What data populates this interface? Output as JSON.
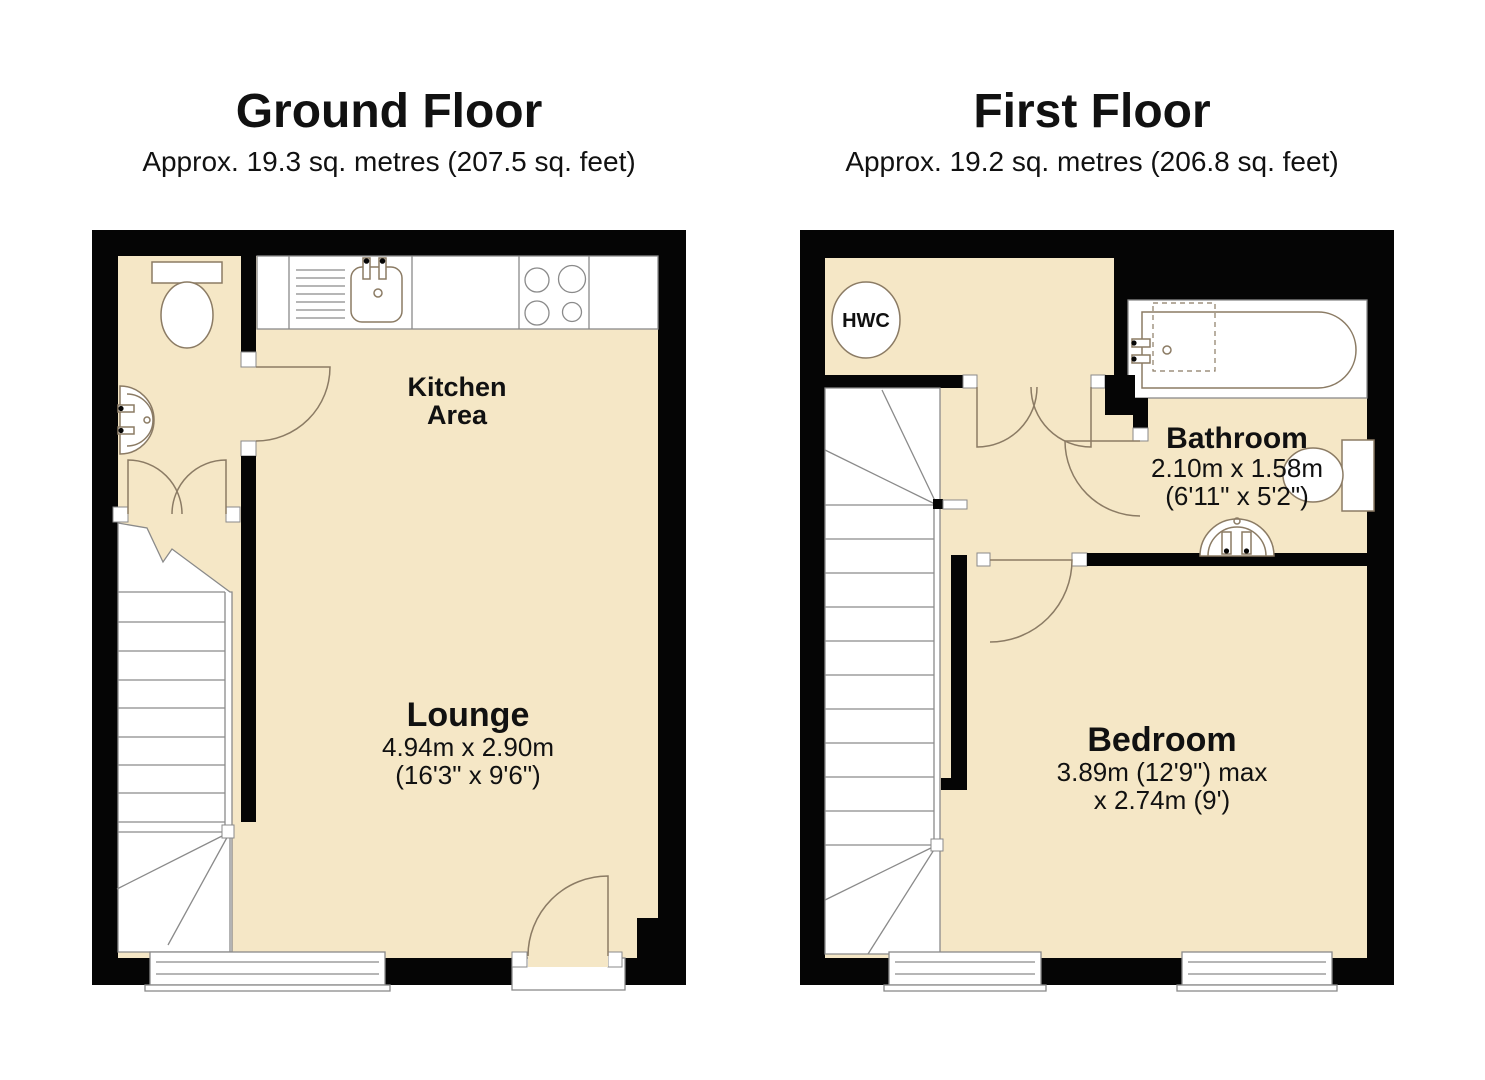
{
  "colors": {
    "background": "#ffffff",
    "wall": "#050505",
    "floor": "#f5e7c6",
    "fixture_outline": "#8b7b64",
    "detail_line": "#8a8a8a",
    "door_line": "#8b7b64",
    "text": "#111111"
  },
  "ground_floor": {
    "title": "Ground Floor",
    "subtitle": "Approx. 19.3 sq. metres (207.5 sq. feet)",
    "kitchen_line1": "Kitchen",
    "kitchen_line2": "Area",
    "lounge_name": "Lounge",
    "lounge_dim_metric": "4.94m x 2.90m",
    "lounge_dim_imperial": "(16'3\" x 9'6\")",
    "fixtures": [
      "toilet-icon",
      "basin-icon",
      "kitchen-sink-icon",
      "drainer-icon",
      "hob-icon",
      "stairs-icon",
      "window-icon",
      "door-swing-icon",
      "double-door-icon",
      "entrance-door-icon"
    ]
  },
  "first_floor": {
    "title": "First Floor",
    "subtitle": "Approx. 19.2 sq. metres (206.8 sq. feet)",
    "hwc_label": "HWC",
    "bathroom_name": "Bathroom",
    "bathroom_dim_metric": "2.10m x 1.58m",
    "bathroom_dim_imperial": "(6'11\" x 5'2\")",
    "bedroom_name": "Bedroom",
    "bedroom_dim_line1": "3.89m (12'9\") max",
    "bedroom_dim_line2": "x 2.74m (9')",
    "fixtures": [
      "bath-icon",
      "shower-screen-icon",
      "toilet-icon",
      "pedestal-basin-icon",
      "hot-water-cylinder-icon",
      "stairs-icon",
      "window-icon",
      "door-swing-icon",
      "double-door-icon"
    ]
  }
}
